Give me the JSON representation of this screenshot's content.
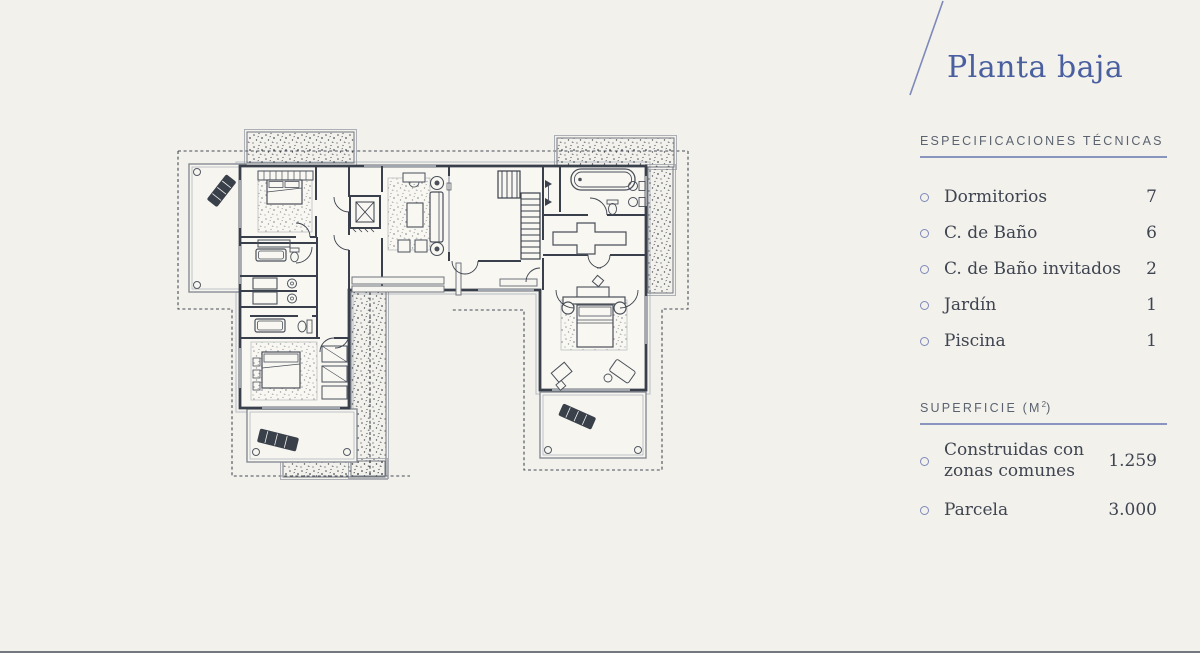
{
  "colors": {
    "background": "#f2f1ec",
    "title_blue": "#4a5fa0",
    "line_blue": "#7d89ba",
    "text_dark": "#3e4450",
    "header_gray": "#5b6370",
    "plan_wall": "#3a404b"
  },
  "panel": {
    "title": "Planta baja",
    "specs": {
      "header": "ESPECIFICACIONES TÉCNICAS",
      "items": [
        {
          "label": "Dormitorios",
          "value": "7"
        },
        {
          "label": "C. de Baño",
          "value": "6"
        },
        {
          "label": "C. de Baño invitados",
          "value": "2"
        },
        {
          "label": "Jardín",
          "value": "1"
        },
        {
          "label": "Piscina",
          "value": "1"
        }
      ]
    },
    "surface": {
      "header_prefix": "SUPERFICIE (M",
      "header_sup": "2",
      "header_suffix": ")",
      "items": [
        {
          "line1": "Construidas con",
          "line2": "zonas comunes",
          "value": "1.259"
        },
        {
          "line1": "Parcela",
          "line2": "",
          "value": "3.000"
        }
      ]
    }
  }
}
